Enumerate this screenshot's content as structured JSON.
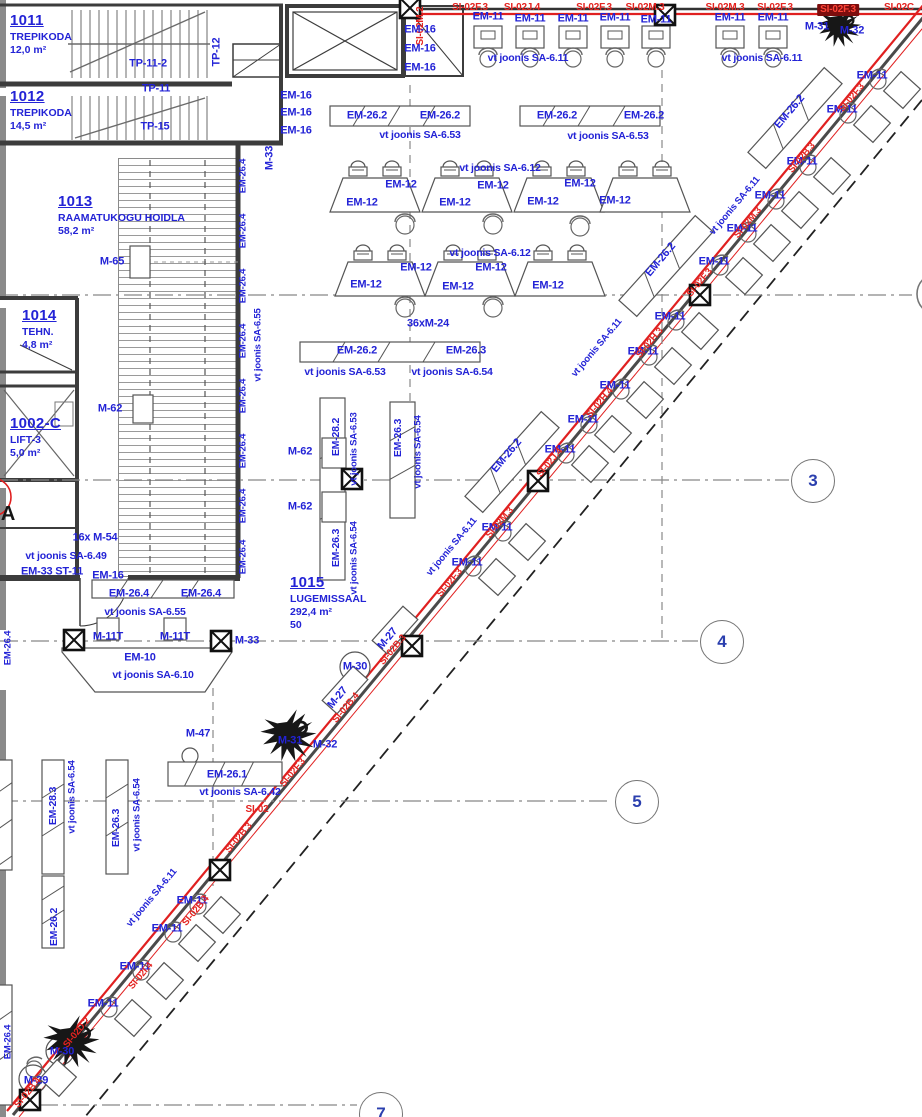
{
  "title": "korruse plaan - lugemissaal",
  "colors": {
    "label_blue": "#2323d6",
    "marker_red": "#e42320",
    "highlight_bg": "#7c0d0d",
    "wall": "#3c3c3c"
  },
  "rooms": [
    {
      "id": "1011",
      "name": "TREPIKODA",
      "area": "12,0 m²",
      "cap": "",
      "x": 10,
      "y": 12
    },
    {
      "id": "1012",
      "name": "TREPIKODA",
      "area": "14,5 m²",
      "cap": "",
      "x": 10,
      "y": 88
    },
    {
      "id": "1013",
      "name": "RAAMATUKOGU HOIDLA",
      "area": "58,2 m²",
      "cap": "",
      "x": 58,
      "y": 193
    },
    {
      "id": "1014",
      "name": "TEHN.",
      "area": "4,8 m²",
      "cap": "",
      "x": 22,
      "y": 307
    },
    {
      "id": "1002-C",
      "name": "LIFT-3",
      "area": "5,0 m²",
      "cap": "",
      "x": 10,
      "y": 415
    },
    {
      "id": "1015",
      "name": "LUGEMISSAAL",
      "area": "292,4 m²",
      "cap": "50",
      "x": 290,
      "y": 574
    }
  ],
  "grid_bubbles": [
    {
      "n": "3",
      "x": 812,
      "y": 480
    },
    {
      "n": "4",
      "x": 721,
      "y": 641
    },
    {
      "n": "5",
      "x": 636,
      "y": 801
    },
    {
      "n": "7",
      "x": 380,
      "y": 1113
    }
  ],
  "labels": [
    {
      "t": "SI-02F.3",
      "x": 470,
      "y": 8,
      "c": "r",
      "s": 10
    },
    {
      "t": "SI-02J.4",
      "x": 522,
      "y": 8,
      "c": "r",
      "s": 10
    },
    {
      "t": "SI-02F.3",
      "x": 594,
      "y": 8,
      "c": "r",
      "s": 10
    },
    {
      "t": "SI-02M.3",
      "x": 645,
      "y": 8,
      "c": "r",
      "s": 10
    },
    {
      "t": "SI-02M.3",
      "x": 725,
      "y": 8,
      "c": "r",
      "s": 10
    },
    {
      "t": "SI-02F.3",
      "x": 775,
      "y": 8,
      "c": "r",
      "s": 10
    },
    {
      "t": "SI-02F.3",
      "x": 838,
      "y": 10,
      "c": "hl",
      "s": 10
    },
    {
      "t": "SI-02C",
      "x": 899,
      "y": 8,
      "c": "r",
      "s": 10
    },
    {
      "t": "SI-02M.2",
      "x": 421,
      "y": 26,
      "c": "r",
      "s": 10,
      "r": -90
    },
    {
      "t": "EM-16",
      "x": 420,
      "y": 30
    },
    {
      "t": "EM-16",
      "x": 420,
      "y": 49
    },
    {
      "t": "EM-16",
      "x": 420,
      "y": 68
    },
    {
      "t": "EM-16",
      "x": 296,
      "y": 96
    },
    {
      "t": "EM-16",
      "x": 296,
      "y": 113
    },
    {
      "t": "EM-16",
      "x": 296,
      "y": 131
    },
    {
      "t": "EM-11",
      "x": 488,
      "y": 17
    },
    {
      "t": "EM-11",
      "x": 530,
      "y": 19
    },
    {
      "t": "EM-11",
      "x": 573,
      "y": 19
    },
    {
      "t": "EM-11",
      "x": 615,
      "y": 18
    },
    {
      "t": "EM-11",
      "x": 656,
      "y": 20
    },
    {
      "t": "EM-11",
      "x": 730,
      "y": 18
    },
    {
      "t": "EM-11",
      "x": 773,
      "y": 18
    },
    {
      "t": "M-31",
      "x": 817,
      "y": 27
    },
    {
      "t": "M-32",
      "x": 852,
      "y": 31
    },
    {
      "t": "vt joonis SA-6.11",
      "x": 528,
      "y": 58,
      "s": 10.5
    },
    {
      "t": "vt joonis SA-6.11",
      "x": 762,
      "y": 58,
      "s": 10.5
    },
    {
      "t": "EM-26.2",
      "x": 367,
      "y": 116
    },
    {
      "t": "EM-26.2",
      "x": 440,
      "y": 116
    },
    {
      "t": "EM-26.2",
      "x": 557,
      "y": 116
    },
    {
      "t": "EM-26.2",
      "x": 644,
      "y": 116
    },
    {
      "t": "vt joonis SA-6.53",
      "x": 420,
      "y": 135,
      "s": 10.5
    },
    {
      "t": "vt joonis SA-6.53",
      "x": 608,
      "y": 136,
      "s": 10.5
    },
    {
      "t": "vt joonis SA-6.12",
      "x": 500,
      "y": 168,
      "s": 10.5
    },
    {
      "t": "EM-12",
      "x": 362,
      "y": 203
    },
    {
      "t": "EM-12",
      "x": 401,
      "y": 185
    },
    {
      "t": "EM-12",
      "x": 455,
      "y": 203
    },
    {
      "t": "EM-12",
      "x": 493,
      "y": 186
    },
    {
      "t": "EM-12",
      "x": 543,
      "y": 202
    },
    {
      "t": "EM-12",
      "x": 580,
      "y": 184
    },
    {
      "t": "EM-12",
      "x": 615,
      "y": 201
    },
    {
      "t": "vt joonis SA-6.12",
      "x": 490,
      "y": 253,
      "s": 10.5
    },
    {
      "t": "EM-12",
      "x": 366,
      "y": 285
    },
    {
      "t": "EM-12",
      "x": 416,
      "y": 268
    },
    {
      "t": "EM-12",
      "x": 458,
      "y": 287
    },
    {
      "t": "EM-12",
      "x": 491,
      "y": 268
    },
    {
      "t": "EM-12",
      "x": 548,
      "y": 286
    },
    {
      "t": "36xM-24",
      "x": 428,
      "y": 324
    },
    {
      "t": "EM-26.2",
      "x": 357,
      "y": 351
    },
    {
      "t": "EM-26.3",
      "x": 466,
      "y": 351
    },
    {
      "t": "vt joonis SA-6.53",
      "x": 345,
      "y": 372,
      "s": 10.5
    },
    {
      "t": "vt joonis SA-6.54",
      "x": 452,
      "y": 372,
      "s": 10.5
    },
    {
      "t": "EM-28.2",
      "x": 336,
      "y": 437,
      "r": -90,
      "s": 10.5
    },
    {
      "t": "vt joonis SA-6.53",
      "x": 354,
      "y": 449,
      "r": -90,
      "s": 9.5
    },
    {
      "t": "EM-26.3",
      "x": 336,
      "y": 548,
      "r": -90,
      "s": 10.5
    },
    {
      "t": "vt joonis SA-6.54",
      "x": 354,
      "y": 558,
      "r": -90,
      "s": 9.5
    },
    {
      "t": "EM-26.3",
      "x": 398,
      "y": 438,
      "r": -90,
      "s": 10.5
    },
    {
      "t": "vt joonis SA-6.54",
      "x": 418,
      "y": 452,
      "r": -90,
      "s": 9.5
    },
    {
      "t": "M-65",
      "x": 112,
      "y": 262
    },
    {
      "t": "M-62",
      "x": 110,
      "y": 409
    },
    {
      "t": "M-62",
      "x": 300,
      "y": 452
    },
    {
      "t": "M-62",
      "x": 300,
      "y": 507
    },
    {
      "t": "M-33",
      "x": 270,
      "y": 158,
      "r": -90
    },
    {
      "t": "EM-26.4",
      "x": 243,
      "y": 176,
      "r": -90,
      "s": 9.5
    },
    {
      "t": "EM-26.4",
      "x": 243,
      "y": 231,
      "r": -90,
      "s": 9.5
    },
    {
      "t": "EM-26.4",
      "x": 243,
      "y": 286,
      "r": -90,
      "s": 9.5
    },
    {
      "t": "EM-26.4",
      "x": 243,
      "y": 341,
      "r": -90,
      "s": 9.5
    },
    {
      "t": "EM-26.4",
      "x": 243,
      "y": 396,
      "r": -90,
      "s": 9.5
    },
    {
      "t": "EM-26.4",
      "x": 243,
      "y": 451,
      "r": -90,
      "s": 9.5
    },
    {
      "t": "EM-26.4",
      "x": 243,
      "y": 506,
      "r": -90,
      "s": 9.5
    },
    {
      "t": "EM-26.4",
      "x": 243,
      "y": 557,
      "r": -90,
      "s": 9.5
    },
    {
      "t": "vt joonis SA-6.55",
      "x": 258,
      "y": 345,
      "r": -90,
      "s": 9.5
    },
    {
      "t": "TP-11-2",
      "x": 148,
      "y": 64
    },
    {
      "t": "TP-11",
      "x": 156,
      "y": 89
    },
    {
      "t": "TP-15",
      "x": 155,
      "y": 127
    },
    {
      "t": "TP-12",
      "x": 217,
      "y": 52,
      "r": -90
    },
    {
      "t": "16x M-54",
      "x": 95,
      "y": 538
    },
    {
      "t": "vt joonis SA-6.49",
      "x": 66,
      "y": 556,
      "s": 10.5
    },
    {
      "t": "EM-33 ST-11",
      "x": 52,
      "y": 572
    },
    {
      "t": "EM-16",
      "x": 108,
      "y": 576
    },
    {
      "t": "EM-26.4",
      "x": 129,
      "y": 594
    },
    {
      "t": "EM-26.4",
      "x": 201,
      "y": 594
    },
    {
      "t": "vt joonis SA-6.55",
      "x": 145,
      "y": 612,
      "s": 10.5
    },
    {
      "t": "M-11T",
      "x": 108,
      "y": 637
    },
    {
      "t": "M-11T",
      "x": 175,
      "y": 637
    },
    {
      "t": "M-33",
      "x": 247,
      "y": 641
    },
    {
      "t": "EM-10",
      "x": 140,
      "y": 658
    },
    {
      "t": "vt joonis SA-6.10",
      "x": 153,
      "y": 675,
      "s": 10.5
    },
    {
      "t": "EM-26.4",
      "x": 8,
      "y": 648,
      "r": -90,
      "s": 9.5
    },
    {
      "t": "M-47",
      "x": 198,
      "y": 734
    },
    {
      "t": "M-31",
      "x": 290,
      "y": 741
    },
    {
      "t": "M-32",
      "x": 325,
      "y": 745
    },
    {
      "t": "M-27",
      "x": 338,
      "y": 698,
      "r": -50
    },
    {
      "t": "M-27",
      "x": 388,
      "y": 639,
      "r": -50
    },
    {
      "t": "M-30",
      "x": 355,
      "y": 667
    },
    {
      "t": "EM-26.1",
      "x": 227,
      "y": 775
    },
    {
      "t": "vt joonis SA-6.42",
      "x": 240,
      "y": 792,
      "s": 10.5
    },
    {
      "t": "SI-02",
      "x": 257,
      "y": 810,
      "c": "r",
      "s": 10
    },
    {
      "t": "EM-28.3",
      "x": 53,
      "y": 806,
      "r": -90,
      "s": 10.5
    },
    {
      "t": "vt joonis SA-6.54",
      "x": 72,
      "y": 797,
      "r": -90,
      "s": 9.5
    },
    {
      "t": "EM-26.3",
      "x": 116,
      "y": 828,
      "r": -90,
      "s": 10.5
    },
    {
      "t": "vt joonis SA-6.54",
      "x": 137,
      "y": 815,
      "r": -90,
      "s": 9.5
    },
    {
      "t": "EM-26.2",
      "x": 54,
      "y": 927,
      "r": -90,
      "s": 10.5
    },
    {
      "t": "EM-26.4",
      "x": 8,
      "y": 1042,
      "r": -90,
      "s": 9.5
    },
    {
      "t": "EM-11",
      "x": 192,
      "y": 901
    },
    {
      "t": "EM-11",
      "x": 167,
      "y": 929
    },
    {
      "t": "EM-11",
      "x": 135,
      "y": 967
    },
    {
      "t": "EM-11",
      "x": 103,
      "y": 1004
    },
    {
      "t": "vt joonis SA-6.11",
      "x": 152,
      "y": 898,
      "r": -50,
      "s": 9.5
    },
    {
      "t": "M-30",
      "x": 62,
      "y": 1052
    },
    {
      "t": "M-29",
      "x": 36,
      "y": 1081
    },
    {
      "t": "EM-11",
      "x": 872,
      "y": 76
    },
    {
      "t": "EM-11",
      "x": 842,
      "y": 110
    },
    {
      "t": "EM-11",
      "x": 802,
      "y": 162
    },
    {
      "t": "EM-11",
      "x": 770,
      "y": 196
    },
    {
      "t": "EM-11",
      "x": 742,
      "y": 229
    },
    {
      "t": "EM-11",
      "x": 714,
      "y": 262
    },
    {
      "t": "EM-11",
      "x": 670,
      "y": 317
    },
    {
      "t": "EM-11",
      "x": 643,
      "y": 352
    },
    {
      "t": "EM-11",
      "x": 615,
      "y": 386
    },
    {
      "t": "vt joonis SA-6.11",
      "x": 735,
      "y": 206,
      "r": -50,
      "s": 9.5
    },
    {
      "t": "vt joonis SA-6.11",
      "x": 597,
      "y": 348,
      "r": -50,
      "s": 9.5
    },
    {
      "t": "EM-26.2",
      "x": 790,
      "y": 112,
      "r": -50
    },
    {
      "t": "EM-26.2",
      "x": 661,
      "y": 260,
      "r": -50
    },
    {
      "t": "EM-26.2",
      "x": 507,
      "y": 456,
      "r": -50
    },
    {
      "t": "EM-11",
      "x": 583,
      "y": 420
    },
    {
      "t": "EM-11",
      "x": 560,
      "y": 450
    },
    {
      "t": "EM-11",
      "x": 497,
      "y": 528
    },
    {
      "t": "EM-11",
      "x": 467,
      "y": 563
    },
    {
      "t": "vt joonis SA-6.11",
      "x": 452,
      "y": 547,
      "r": -50,
      "s": 9.5
    },
    {
      "t": "SI-02F.3",
      "x": 852,
      "y": 98,
      "c": "r",
      "r": -50,
      "s": 9.5
    },
    {
      "t": "SI-02B.3",
      "x": 802,
      "y": 158,
      "c": "r",
      "r": -50,
      "s": 9.5
    },
    {
      "t": "SI-02M.3",
      "x": 748,
      "y": 223,
      "c": "r",
      "r": -50,
      "s": 9.5
    },
    {
      "t": "SI-02F.3",
      "x": 700,
      "y": 283,
      "c": "r",
      "r": -50,
      "s": 9.5
    },
    {
      "t": "SI-02H.3",
      "x": 650,
      "y": 343,
      "c": "r",
      "r": -50,
      "s": 9.5
    },
    {
      "t": "SI-02H.4",
      "x": 600,
      "y": 403,
      "c": "r",
      "r": -50,
      "s": 9.5
    },
    {
      "t": "SI-02J.4",
      "x": 550,
      "y": 463,
      "c": "r",
      "r": -50,
      "s": 9.5
    },
    {
      "t": "SI-02M.3",
      "x": 500,
      "y": 523,
      "c": "r",
      "r": -50,
      "s": 9.5
    },
    {
      "t": "SI-02F.3",
      "x": 450,
      "y": 583,
      "c": "r",
      "r": -50,
      "s": 9.5
    },
    {
      "t": "SI-02B.3",
      "x": 393,
      "y": 650,
      "c": "r",
      "r": -50,
      "s": 9.5
    },
    {
      "t": "SI-02B.4",
      "x": 346,
      "y": 708,
      "c": "r",
      "r": -50,
      "s": 9.5
    },
    {
      "t": "SI-02F.3",
      "x": 293,
      "y": 773,
      "c": "r",
      "r": -50,
      "s": 9.5
    },
    {
      "t": "SI-02B.3",
      "x": 239,
      "y": 838,
      "c": "r",
      "r": -50,
      "s": 9.5
    },
    {
      "t": "SI-02B.4",
      "x": 196,
      "y": 911,
      "c": "r",
      "r": -50,
      "s": 9.5
    },
    {
      "t": "SI-02I.4",
      "x": 141,
      "y": 976,
      "c": "r",
      "r": -50,
      "s": 9.5
    },
    {
      "t": "SI-02D.2",
      "x": 77,
      "y": 1033,
      "c": "r",
      "r": -50,
      "s": 9.5
    },
    {
      "t": "SI-02B.4",
      "x": 28,
      "y": 1093,
      "c": "r",
      "r": -50,
      "s": 9.5
    },
    {
      "t": "A",
      "x": 8,
      "y": 514,
      "c": "k",
      "s": 20
    }
  ]
}
